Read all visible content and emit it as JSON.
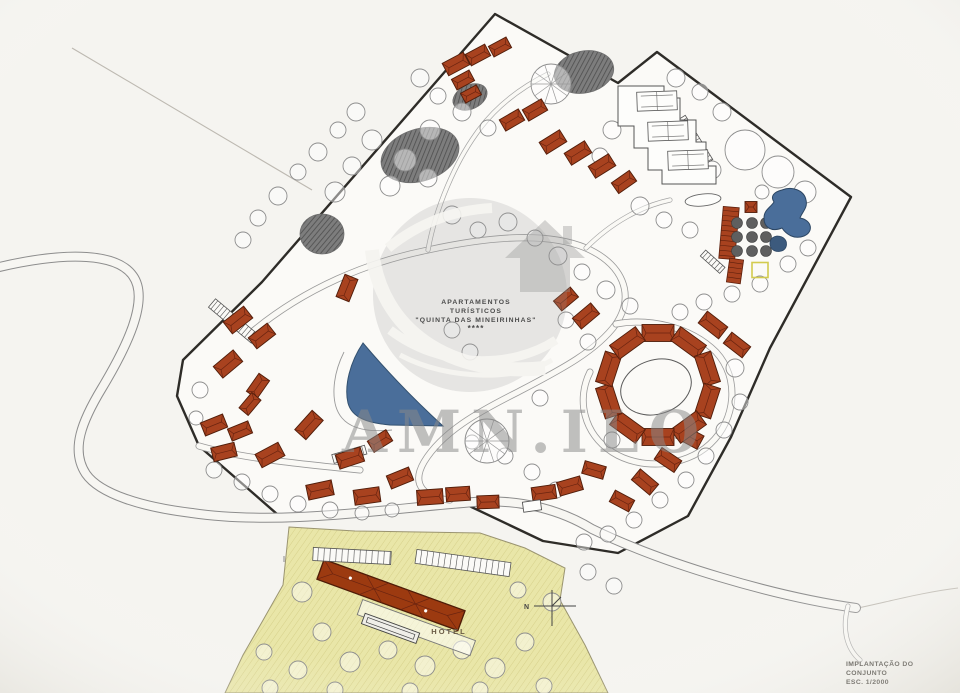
{
  "page": {
    "paper": "#f5f4f0",
    "site_fill": "#fbfaf7"
  },
  "title": {
    "line1": "APARTAMENTOS",
    "line2": "TURÍSTICOS",
    "line3": "\"QUINTA DAS MINEIRINHAS\"",
    "line4": "****"
  },
  "hotel_label": "HOTEL",
  "north_label": "N",
  "caption": {
    "line1": "IMPLANTAÇÃO DO",
    "line2": "CONJUNTO",
    "line3": "ESC. 1/2000"
  },
  "watermark": {
    "text": "AMN.ILO"
  },
  "colors": {
    "building": "#a8421f",
    "building_stroke": "#4f1d0a",
    "hotel_roof": "#9c3a10",
    "pool": "#4a6e9a",
    "pool_dark": "#3c5a7d",
    "pool_stroke": "#2c4663",
    "ground_yellow": "#e9e6a8",
    "boundary": "#2e2c28",
    "yellow_square": "#d3cb4e"
  },
  "plan": {
    "boundary_points": "495,14 618,83 657,52 851,197 770,348 731,437 688,516 618,553 543,541 463,503 285,521 199,446 177,396 183,360 262,282",
    "yellow_points": "289,527 355,531 480,533 525,548 565,568 560,600 585,645 608,693 225,693 243,655 262,622 283,585",
    "tennis_points": "618,86 664,86 664,98 680,98 680,120 696,120 696,142 706,142 706,166 716,166 716,184 662,184 662,170 648,170 648,148 634,148 634,126 618,126",
    "lake_d": "M 363,343 C 350,362 344,386 348,403 C 352,418 368,423 390,425 L 443,426 C 420,405 390,375 363,343 Z",
    "lake_contour_d": "M 344,352 C 332,376 330,404 342,418 C 352,430 372,432 392,430",
    "pool_d": "M 782,190 C 792,186 804,190 806,200 C 808,208 802,212 800,218 C 812,220 814,232 804,236 C 794,240 786,234 782,228 C 772,232 764,228 764,218 C 764,210 770,208 774,202 C 770,196 774,192 782,190 Z",
    "pool_small_d": "M 777,236 C 784,236 788,241 786,247 C 784,252 776,253 772,249 C 768,244 770,237 777,236 Z",
    "roads": {
      "left_outer": "M -5,268 C 70,250 118,254 133,276 C 150,300 126,348 102,388 C 82,421 70,450 86,474 C 100,494 142,507 192,513",
      "bottom": "M 192,513 C 280,526 385,509 463,503",
      "right": "M 463,503 C 522,496 566,513 592,529 C 662,563 772,596 856,608",
      "hook": "M 848,606 C 842,628 846,648 860,660",
      "inner_loop": "M 252,332 C 305,288 368,262 428,250 C 492,236 548,232 586,248 C 622,264 636,294 616,324 C 596,352 556,372 518,392 C 478,412 442,432 424,462 C 410,486 426,498 450,500",
      "spur_top": "M 428,250 C 436,206 456,162 476,134 C 494,108 520,88 548,74",
      "spur_tennis": "M 586,248 C 612,222 642,206 670,200",
      "ring_road": "M 616,324 C 648,318 690,326 716,352 C 740,378 736,420 710,444 C 684,468 640,470 612,452 C 584,434 576,400 590,372",
      "west_inner": "M 199,446 C 240,458 300,464 360,470"
    },
    "buildings": [
      [
        238,
        320,
        26,
        15,
        -38
      ],
      [
        262,
        336,
        24,
        14,
        -38
      ],
      [
        228,
        364,
        26,
        15,
        -40
      ],
      [
        258,
        386,
        22,
        13,
        -55
      ],
      [
        250,
        404,
        20,
        12,
        -50
      ],
      [
        214,
        425,
        24,
        14,
        -22
      ],
      [
        240,
        431,
        22,
        13,
        -22
      ],
      [
        224,
        452,
        24,
        14,
        -14
      ],
      [
        270,
        455,
        26,
        15,
        -28
      ],
      [
        309,
        425,
        26,
        15,
        -48
      ],
      [
        347,
        288,
        24,
        14,
        -68
      ],
      [
        350,
        458,
        26,
        15,
        -18
      ],
      [
        320,
        490,
        26,
        15,
        -12
      ],
      [
        367,
        496,
        26,
        15,
        -8
      ],
      [
        400,
        478,
        24,
        14,
        -22
      ],
      [
        430,
        497,
        26,
        15,
        -4
      ],
      [
        458,
        494,
        24,
        14,
        -4
      ],
      [
        488,
        502,
        22,
        13,
        -2
      ],
      [
        456,
        64,
        24,
        14,
        -28
      ],
      [
        478,
        55,
        22,
        13,
        -28
      ],
      [
        500,
        47,
        20,
        12,
        -28
      ],
      [
        463,
        80,
        20,
        12,
        -28
      ],
      [
        471,
        94,
        18,
        11,
        -28
      ],
      [
        512,
        120,
        22,
        13,
        -30
      ],
      [
        535,
        110,
        22,
        13,
        -30
      ],
      [
        553,
        142,
        24,
        14,
        -32
      ],
      [
        578,
        153,
        24,
        14,
        -32
      ],
      [
        602,
        166,
        24,
        14,
        -32
      ],
      [
        624,
        182,
        22,
        13,
        -35
      ],
      [
        566,
        299,
        22,
        13,
        -40
      ],
      [
        586,
        316,
        24,
        14,
        -40
      ],
      [
        713,
        325,
        26,
        15,
        38
      ],
      [
        737,
        345,
        24,
        14,
        38
      ],
      [
        690,
        437,
        24,
        15,
        28
      ],
      [
        668,
        460,
        24,
        14,
        34
      ],
      [
        645,
        482,
        24,
        14,
        40
      ],
      [
        622,
        501,
        22,
        13,
        28
      ],
      [
        594,
        470,
        22,
        13,
        16
      ],
      [
        570,
        486,
        24,
        14,
        -16
      ],
      [
        544,
        493,
        24,
        14,
        -8
      ],
      [
        380,
        441,
        22,
        13,
        -32
      ],
      [
        751,
        207,
        12,
        11,
        0
      ]
    ],
    "ring": {
      "cx": 658,
      "cy": 385,
      "radius": 52,
      "count": 10,
      "bw": 32,
      "bh": 17
    },
    "courtyard": {
      "cx": 656,
      "cy": 387,
      "rx": 36,
      "ry": 27,
      "rot": -18
    },
    "courts": [
      [
        657,
        101,
        40,
        19
      ],
      [
        668,
        131,
        40,
        19
      ],
      [
        688,
        160,
        40,
        19
      ]
    ],
    "pond": {
      "cx": 703,
      "cy": 200,
      "rx": 18,
      "ry": 6,
      "rot": -6
    },
    "hotel": {
      "x": 391,
      "y": 595,
      "len": 150,
      "wid": 21,
      "rot": 20
    },
    "parking": [
      [
        352,
        556,
        78,
        13,
        3
      ],
      [
        463,
        563,
        95,
        14,
        8
      ]
    ],
    "pergolas": [
      [
        729,
        233,
        16,
        52,
        5
      ],
      [
        735,
        271,
        14,
        24,
        8
      ]
    ],
    "yellow_square": {
      "x": 760,
      "y": 270,
      "w": 16,
      "h": 15
    },
    "stairs": [
      [
        212,
        303,
        56,
        11,
        40
      ],
      [
        681,
        118,
        52,
        10,
        58
      ],
      [
        333,
        459,
        34,
        9,
        -16
      ],
      [
        703,
        253,
        26,
        8,
        42
      ]
    ],
    "dark_blobs": [
      [
        420,
        155,
        40,
        26,
        -18
      ],
      [
        322,
        234,
        22,
        20,
        0
      ],
      [
        584,
        72,
        30,
        21,
        -12
      ],
      [
        470,
        97,
        18,
        12,
        -25
      ]
    ],
    "tree_grid": {
      "xs": [
        737,
        752,
        766
      ],
      "ys": [
        223,
        237,
        251
      ],
      "r": 5.5
    },
    "pin_trees": [
      [
        551,
        84,
        20
      ],
      [
        487,
        441,
        22
      ]
    ],
    "sheds": [
      [
        532,
        506,
        18,
        10,
        -8
      ]
    ],
    "trees": [
      [
        356,
        112,
        9
      ],
      [
        338,
        130,
        8
      ],
      [
        318,
        152,
        9
      ],
      [
        298,
        172,
        8
      ],
      [
        278,
        196,
        9
      ],
      [
        258,
        218,
        8
      ],
      [
        243,
        240,
        8
      ],
      [
        372,
        140,
        10
      ],
      [
        352,
        166,
        9
      ],
      [
        335,
        192,
        10
      ],
      [
        420,
        78,
        9
      ],
      [
        438,
        96,
        8
      ],
      [
        462,
        112,
        9
      ],
      [
        488,
        128,
        8
      ],
      [
        430,
        130,
        10
      ],
      [
        405,
        160,
        11
      ],
      [
        390,
        186,
        10
      ],
      [
        428,
        178,
        9
      ],
      [
        452,
        215,
        9
      ],
      [
        478,
        230,
        8
      ],
      [
        508,
        222,
        9
      ],
      [
        535,
        238,
        8
      ],
      [
        558,
        256,
        9
      ],
      [
        582,
        272,
        8
      ],
      [
        606,
        290,
        9
      ],
      [
        630,
        306,
        8
      ],
      [
        676,
        78,
        9
      ],
      [
        700,
        92,
        8
      ],
      [
        722,
        112,
        9
      ],
      [
        745,
        150,
        20
      ],
      [
        778,
        172,
        16
      ],
      [
        805,
        192,
        11
      ],
      [
        712,
        170,
        9
      ],
      [
        688,
        152,
        8
      ],
      [
        762,
        192,
        7
      ],
      [
        808,
        248,
        8
      ],
      [
        788,
        264,
        8
      ],
      [
        760,
        284,
        8
      ],
      [
        732,
        294,
        8
      ],
      [
        704,
        302,
        8
      ],
      [
        680,
        312,
        8
      ],
      [
        612,
        130,
        9
      ],
      [
        600,
        156,
        8
      ],
      [
        640,
        206,
        9
      ],
      [
        664,
        220,
        8
      ],
      [
        690,
        230,
        8
      ],
      [
        470,
        352,
        8
      ],
      [
        540,
        398,
        8
      ],
      [
        452,
        330,
        8
      ],
      [
        735,
        368,
        9
      ],
      [
        740,
        402,
        8
      ],
      [
        724,
        430,
        8
      ],
      [
        588,
        342,
        8
      ],
      [
        566,
        320,
        8
      ],
      [
        612,
        440,
        8
      ],
      [
        706,
        456,
        8
      ],
      [
        686,
        480,
        8
      ],
      [
        660,
        500,
        8
      ],
      [
        634,
        520,
        8
      ],
      [
        608,
        534,
        8
      ],
      [
        584,
        542,
        8
      ],
      [
        505,
        456,
        8
      ],
      [
        472,
        442,
        7
      ],
      [
        532,
        472,
        8
      ],
      [
        556,
        490,
        8
      ],
      [
        200,
        390,
        8
      ],
      [
        196,
        418,
        7
      ],
      [
        214,
        470,
        8
      ],
      [
        242,
        482,
        8
      ],
      [
        270,
        494,
        8
      ],
      [
        298,
        504,
        8
      ],
      [
        330,
        510,
        8
      ],
      [
        362,
        513,
        7
      ],
      [
        392,
        510,
        7
      ],
      [
        302,
        592,
        10
      ],
      [
        322,
        632,
        9
      ],
      [
        350,
        662,
        10
      ],
      [
        388,
        650,
        9
      ],
      [
        425,
        666,
        10
      ],
      [
        462,
        650,
        9
      ],
      [
        495,
        668,
        10
      ],
      [
        525,
        642,
        9
      ],
      [
        298,
        670,
        9
      ],
      [
        264,
        652,
        8
      ],
      [
        552,
        602,
        9
      ],
      [
        518,
        590,
        8
      ],
      [
        270,
        688,
        8
      ],
      [
        335,
        690,
        8
      ],
      [
        410,
        691,
        8
      ],
      [
        480,
        690,
        8
      ],
      [
        544,
        686,
        8
      ],
      [
        588,
        572,
        8
      ],
      [
        614,
        586,
        8
      ]
    ]
  }
}
